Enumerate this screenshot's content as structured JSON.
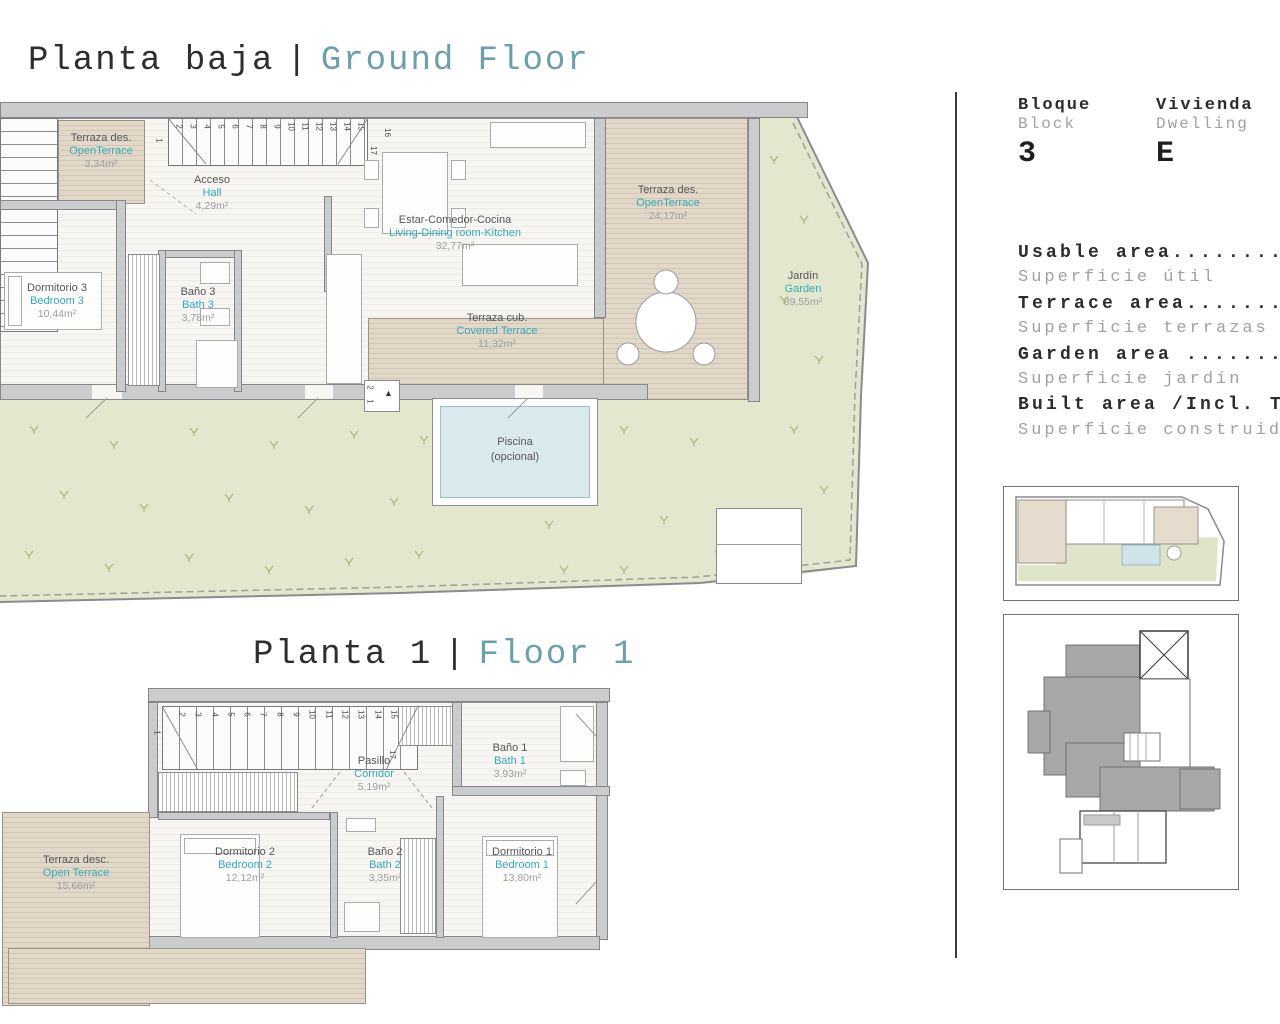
{
  "titles": {
    "ground": {
      "es": "Planta baja",
      "sep": "|",
      "en": "Ground Floor"
    },
    "floor1": {
      "es": "Planta 1",
      "sep": "|",
      "en": "Floor 1"
    }
  },
  "panel": {
    "block": {
      "label_es": "Bloque",
      "label_en": "Block",
      "value": "3"
    },
    "dwelling": {
      "label_es": "Vivienda",
      "label_en": "Dwelling",
      "value": "E"
    },
    "areas": [
      {
        "en": "Usable area....................",
        "es": "Superficie útil"
      },
      {
        "en": "Terrace area...................",
        "es": "Superficie terrazas"
      },
      {
        "en": "Garden area ...................",
        "es": "Superficie jardín"
      },
      {
        "en": "Built area /Incl. Terr",
        "es": "Superficie construida"
      }
    ]
  },
  "groundFloor": {
    "rooms": {
      "terrace_small": {
        "es": "Terraza des.",
        "en": "OpenTerrace",
        "area": "3,34m²"
      },
      "hall": {
        "es": "Acceso",
        "en": "Hall",
        "area": "4,29m²"
      },
      "living": {
        "es": "Estar-Comedor-Cocina",
        "en": "Living-Dining room-Kitchen",
        "area": "32,77m²"
      },
      "bedroom3": {
        "es": "Dormitorio 3",
        "en": "Bedroom 3",
        "area": "10,44m²"
      },
      "bath3": {
        "es": "Baño 3",
        "en": "Bath 3",
        "area": "3,78m²"
      },
      "covered_terrace": {
        "es": "Terraza cub.",
        "en": "Covered Terrace",
        "area": "11,32m²"
      },
      "open_terrace": {
        "es": "Terraza des.",
        "en": "OpenTerrace",
        "area": "24,17m²"
      },
      "garden": {
        "es": "Jardín",
        "en": "Garden",
        "area": "89,55m²"
      },
      "pool": {
        "line1": "Piscina",
        "line2": "(opcional)"
      }
    },
    "stairs": {
      "first": "1",
      "top_numbers": [
        "2",
        "3",
        "4",
        "5",
        "6",
        "7",
        "8",
        "9",
        "10",
        "11",
        "12",
        "13",
        "14",
        "15"
      ],
      "landing": [
        "17",
        "16"
      ],
      "left_numbers": [
        "1",
        "2",
        "3",
        "4",
        "5"
      ]
    },
    "steps": [
      "2",
      "1"
    ]
  },
  "floor1": {
    "rooms": {
      "open_terrace": {
        "es": "Terraza desc.",
        "en": "Open Terrace",
        "area": "15,66m²"
      },
      "corridor": {
        "es": "Pasillo",
        "en": "Corridor",
        "area": "5,19m²"
      },
      "bath1": {
        "es": "Baño 1",
        "en": "Bath 1",
        "area": "3,93m²"
      },
      "bedroom2": {
        "es": "Dormitorio 2",
        "en": "Bedroom 2",
        "area": "12,12m²"
      },
      "bath2": {
        "es": "Baño 2",
        "en": "Bath 2",
        "area": "3,35m²"
      },
      "bedroom1": {
        "es": "Dormitorio 1",
        "en": "Bedroom 1",
        "area": "13,80m²"
      }
    },
    "stairs": {
      "first": "1",
      "top_numbers": [
        "2",
        "3",
        "4",
        "5",
        "6",
        "7",
        "8",
        "9",
        "10",
        "11",
        "12",
        "13",
        "14",
        "15"
      ],
      "landing": [
        "17",
        "16"
      ]
    }
  },
  "colors": {
    "accent_teal": "#35a9b7",
    "title_teal": "#6b9fab",
    "garden_green": "#e2e7cd",
    "grass_mark": "#a9ba76",
    "deck_beige": "#ddd2c2",
    "pool_blue": "#d9e9ee",
    "wall_gray": "#cbccce",
    "text_dark": "#2c2c2e",
    "text_gray": "#9b9c9e"
  }
}
